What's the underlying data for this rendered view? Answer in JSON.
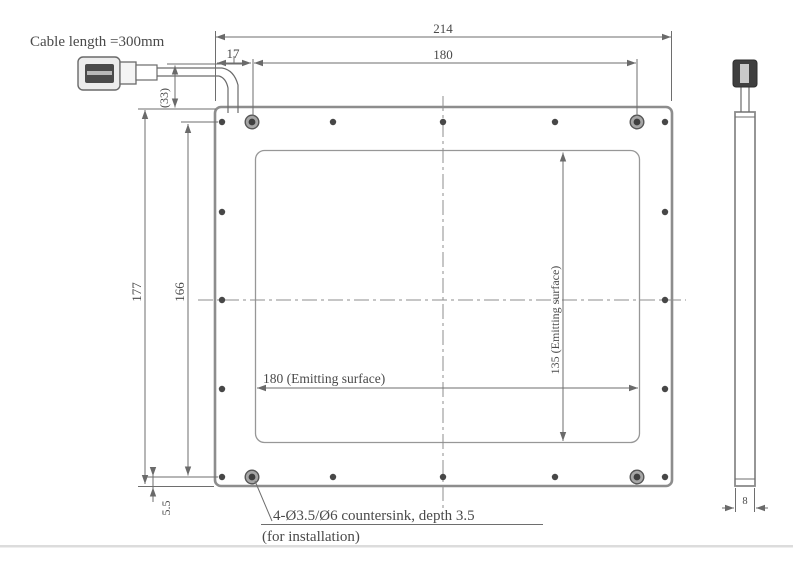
{
  "labels": {
    "cable_note": "Cable length =300mm",
    "overall_width": "214",
    "hole_pitch_width": "180",
    "edge_offset": "17",
    "cable_offset_ref": "(33)",
    "overall_height": "177",
    "hole_pitch_height": "166",
    "bottom_edge_offset": "5.5",
    "emitting_width": "180 (Emitting surface)",
    "emitting_height": "135 (Emitting surface)",
    "thickness": "8",
    "countersink_note_line1": "4-Ø3.5/Ø6 countersink, depth 3.5",
    "countersink_note_line2": "(for installation)"
  },
  "colors": {
    "line": "#6e6e6e",
    "panel_outline": "#8d8d8d",
    "hole": "#474747",
    "text": "#4a4a4a",
    "divider": "#dcdcdc"
  }
}
